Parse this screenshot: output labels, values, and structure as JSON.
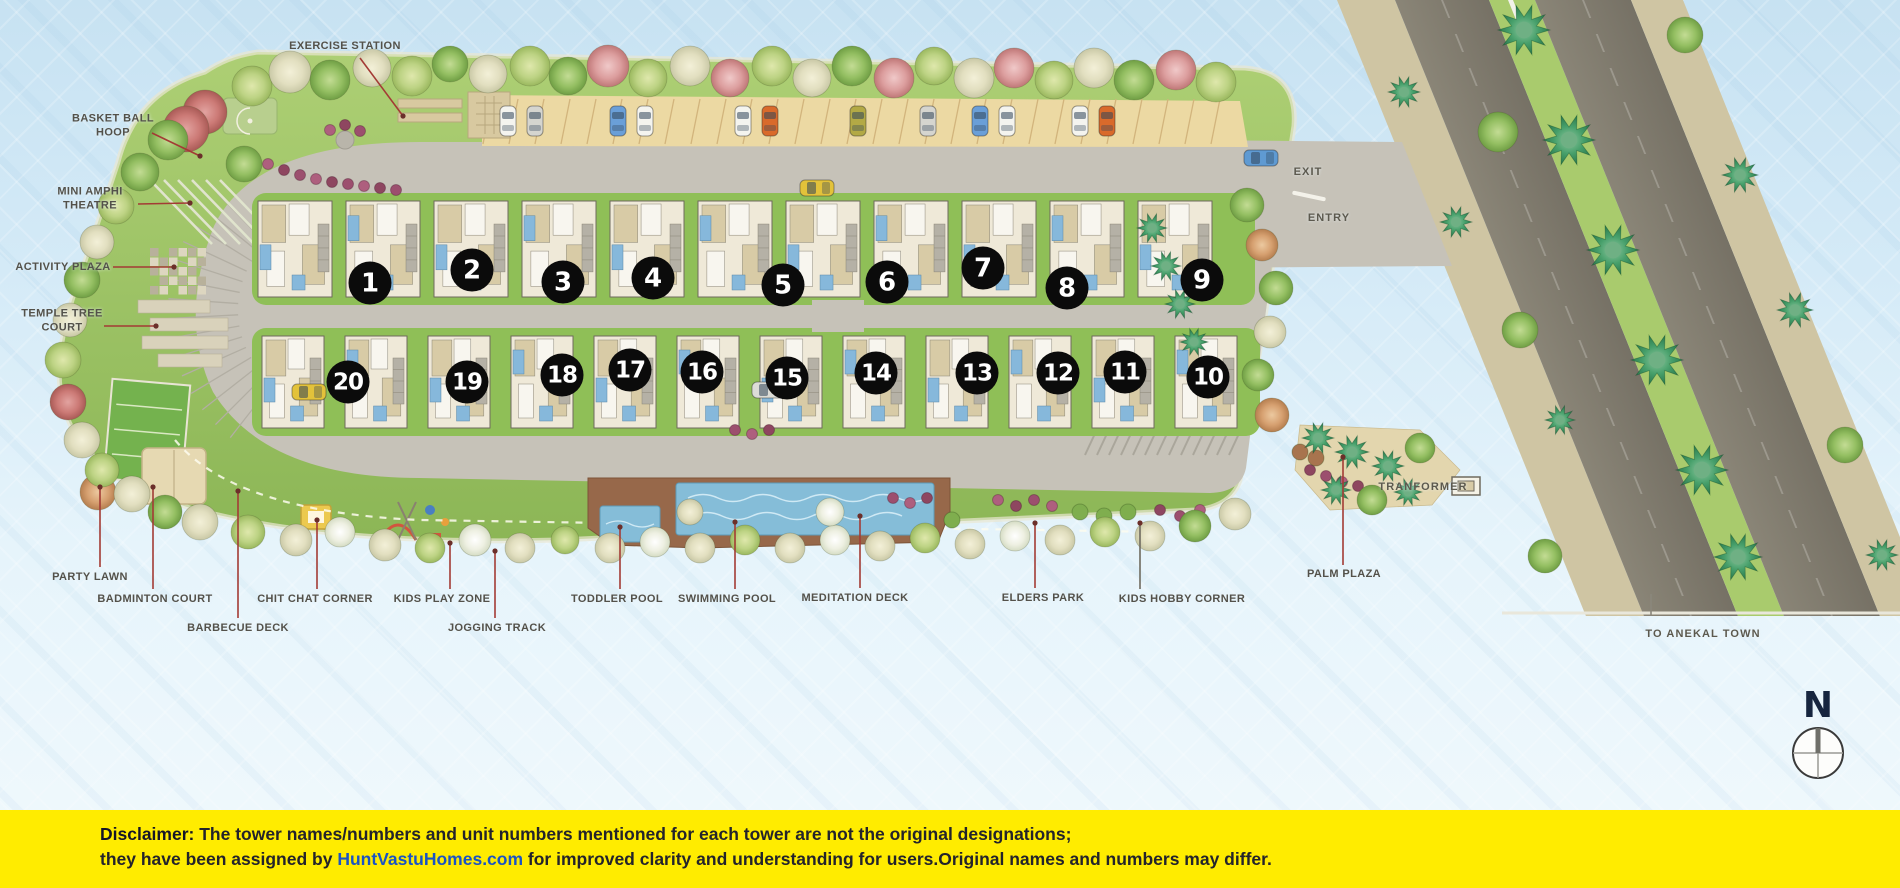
{
  "plan": {
    "towers": [
      {
        "n": "1",
        "x": 370,
        "y": 283
      },
      {
        "n": "2",
        "x": 472,
        "y": 270
      },
      {
        "n": "3",
        "x": 563,
        "y": 282
      },
      {
        "n": "4",
        "x": 653,
        "y": 278
      },
      {
        "n": "5",
        "x": 783,
        "y": 285
      },
      {
        "n": "6",
        "x": 887,
        "y": 282
      },
      {
        "n": "7",
        "x": 983,
        "y": 268
      },
      {
        "n": "8",
        "x": 1067,
        "y": 288
      },
      {
        "n": "9",
        "x": 1202,
        "y": 280
      },
      {
        "n": "10",
        "x": 1208,
        "y": 377
      },
      {
        "n": "11",
        "x": 1125,
        "y": 372
      },
      {
        "n": "12",
        "x": 1058,
        "y": 373
      },
      {
        "n": "13",
        "x": 977,
        "y": 373
      },
      {
        "n": "14",
        "x": 876,
        "y": 373
      },
      {
        "n": "15",
        "x": 787,
        "y": 378
      },
      {
        "n": "16",
        "x": 702,
        "y": 372
      },
      {
        "n": "17",
        "x": 630,
        "y": 370
      },
      {
        "n": "18",
        "x": 562,
        "y": 375
      },
      {
        "n": "19",
        "x": 467,
        "y": 382
      },
      {
        "n": "20",
        "x": 348,
        "y": 382
      }
    ],
    "amenities": [
      {
        "id": "exercise-station",
        "text": "EXERCISE STATION",
        "x": 345,
        "y": 46,
        "leader": [
          360,
          58,
          403,
          116
        ]
      },
      {
        "id": "basket-ball-hoop",
        "text": "BASKET BALL\nHOOP",
        "x": 113,
        "y": 126,
        "leader": [
          152,
          133,
          200,
          156
        ]
      },
      {
        "id": "mini-amphi-theatre",
        "text": "MINI AMPHI\nTHEATRE",
        "x": 90,
        "y": 199,
        "leader": [
          138,
          204,
          190,
          203
        ]
      },
      {
        "id": "activity-plaza",
        "text": "ACTIVITY PLAZA",
        "x": 63,
        "y": 267,
        "leader": [
          113,
          267,
          174,
          267
        ]
      },
      {
        "id": "temple-tree-court",
        "text": "TEMPLE TREE\nCOURT",
        "x": 62,
        "y": 321,
        "leader": [
          104,
          326,
          156,
          326
        ]
      },
      {
        "id": "party-lawn",
        "text": "PARTY LAWN",
        "x": 90,
        "y": 577,
        "leader": [
          100,
          567,
          100,
          487
        ]
      },
      {
        "id": "badminton-court",
        "text": "BADMINTON COURT",
        "x": 155,
        "y": 599,
        "leader": [
          153,
          589,
          153,
          487
        ]
      },
      {
        "id": "barbecue-deck",
        "text": "BARBECUE DECK",
        "x": 238,
        "y": 628,
        "leader": [
          238,
          618,
          238,
          491
        ]
      },
      {
        "id": "chit-chat-corner",
        "text": "CHIT CHAT CORNER",
        "x": 315,
        "y": 599,
        "leader": [
          317,
          589,
          317,
          520
        ]
      },
      {
        "id": "kids-play-zone",
        "text": "KIDS PLAY ZONE",
        "x": 442,
        "y": 599,
        "leader": [
          450,
          589,
          450,
          543
        ]
      },
      {
        "id": "jogging-track",
        "text": "JOGGING TRACK",
        "x": 497,
        "y": 628,
        "leader": [
          495,
          618,
          495,
          551
        ]
      },
      {
        "id": "toddler-pool",
        "text": "TODDLER POOL",
        "x": 617,
        "y": 599,
        "leader": [
          620,
          589,
          620,
          527
        ]
      },
      {
        "id": "swimming-pool",
        "text": "SWIMMING POOL",
        "x": 727,
        "y": 599,
        "leader": [
          735,
          589,
          735,
          522
        ]
      },
      {
        "id": "meditation-deck",
        "text": "MEDITATION DECK",
        "x": 855,
        "y": 598,
        "leader": [
          860,
          588,
          860,
          516
        ]
      },
      {
        "id": "elders-park",
        "text": "ELDERS PARK",
        "x": 1043,
        "y": 598,
        "leader": [
          1035,
          588,
          1035,
          523
        ]
      },
      {
        "id": "kids-hobby-corner",
        "text": "KIDS HOBBY CORNER",
        "x": 1182,
        "y": 599,
        "leader": [
          1140,
          589,
          1140,
          523
        ],
        "lc": "#6f6b60"
      },
      {
        "id": "palm-plaza",
        "text": "PALM PLAZA",
        "x": 1344,
        "y": 574,
        "leader": [
          1343,
          565,
          1343,
          457
        ]
      }
    ],
    "roads": [
      {
        "id": "exit",
        "text": "EXIT",
        "x": 1308,
        "y": 172
      },
      {
        "id": "entry",
        "text": "ENTRY",
        "x": 1329,
        "y": 218
      },
      {
        "id": "tranformer",
        "text": "TRANFORMER",
        "x": 1423,
        "y": 487
      },
      {
        "id": "to-anekal-town",
        "text": "TO ANEKAL TOWN",
        "x": 1703,
        "y": 634,
        "leader": [
          1651,
          594,
          1651,
          616
        ],
        "lc": "#8a877c",
        "nodot": true
      }
    ],
    "compass": {
      "label": "N"
    }
  },
  "colors": {
    "disclaimer_bg": "#FFEC00",
    "brand_blue": "#1a53c4",
    "leader_red": "#a33b35",
    "badge_black": "#0b0b0b"
  },
  "disclaimer": {
    "prefix": "Disclaimer:",
    "line1": " The tower names/numbers and unit numbers mentioned for each tower are not the original designations;",
    "line2_before": "they have been assigned by ",
    "brand": "HuntVastuHomes.com",
    "line2_after": " for improved clarity and understanding for users.Original names and numbers may differ."
  }
}
